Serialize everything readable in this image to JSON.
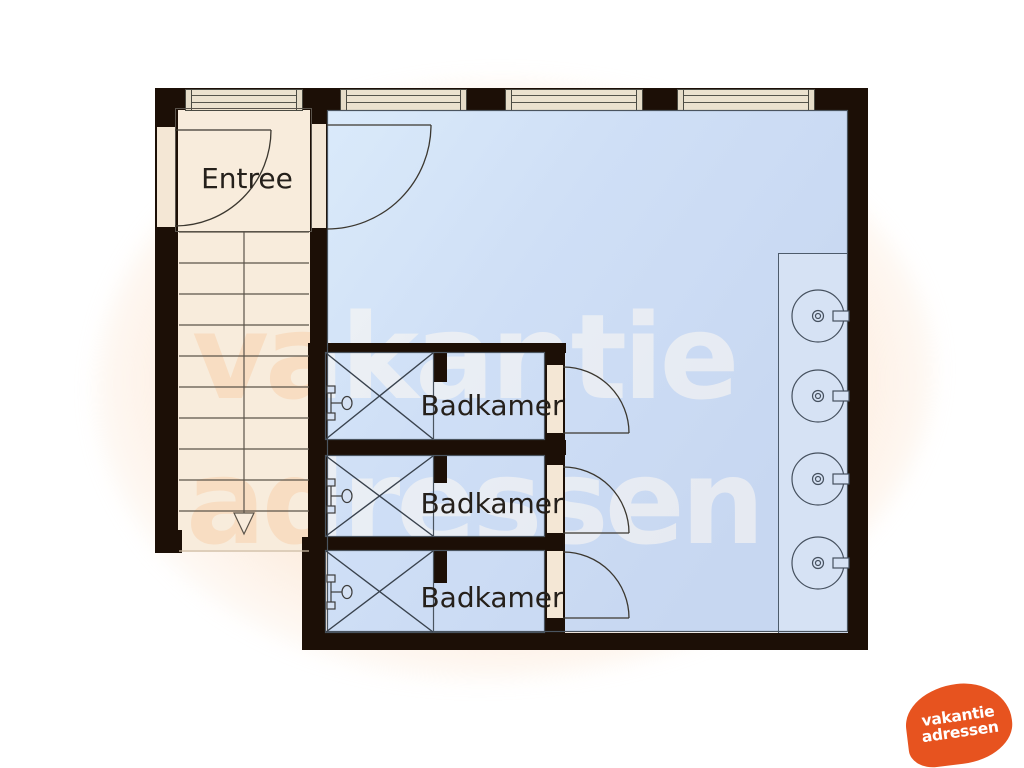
{
  "plan_title": "floorplan",
  "rooms": [
    {
      "id": "entree",
      "label": "Entree"
    },
    {
      "id": "badkamer-1",
      "label": "Badkamer"
    },
    {
      "id": "badkamer-2",
      "label": "Badkamer"
    },
    {
      "id": "badkamer-3",
      "label": "Badkamer"
    }
  ],
  "watermark": {
    "line1": "vakantie",
    "line2": "adressen"
  },
  "logo": {
    "line1": "vakantie",
    "line2": "adressen",
    "color": "#e7531f",
    "text_color": "#ffffff"
  },
  "fixtures": {
    "sinks": 4,
    "showers": 3,
    "doors": 5,
    "windows_top_wall": 4,
    "staircase_steps": 10,
    "stair_arrow_direction": "down"
  },
  "colors": {
    "wall": "#1c0f06",
    "floor_main_room": "#cbdcf5",
    "floor_entree_stairs": "#f8ecdc",
    "counter": "#d6e2f4",
    "window_frame": "#ebe2cf",
    "accent_orange": "#e7531f"
  }
}
